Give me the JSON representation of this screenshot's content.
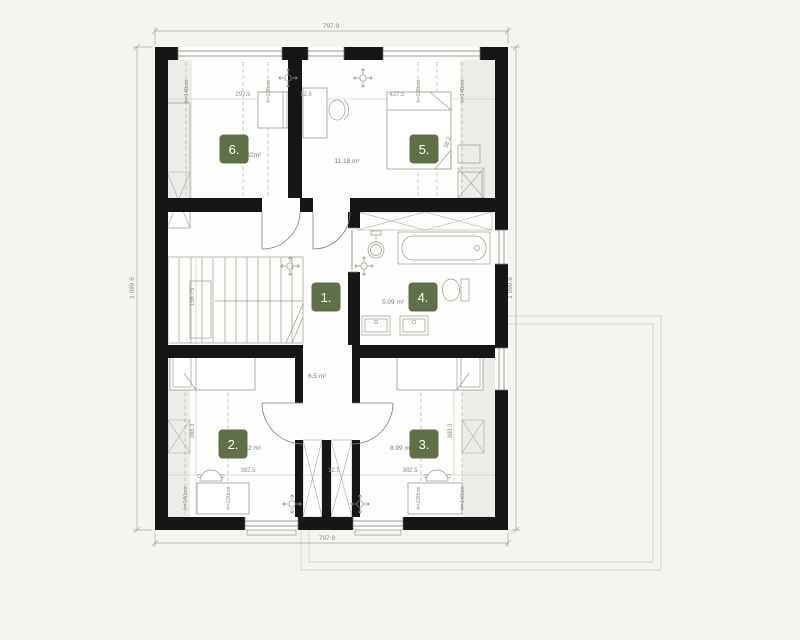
{
  "floorplan": {
    "overall": {
      "width_top": "797.9",
      "width_bottom": "797.9",
      "height_left": "1 099.6",
      "height_right": "1 099.6"
    },
    "rooms": [
      {
        "id": 1,
        "label": "1.",
        "area": "6.5 m²"
      },
      {
        "id": 2,
        "label": "2.",
        "area": "9.02 m²"
      },
      {
        "id": 3,
        "label": "3.",
        "area": "8.99 m²"
      },
      {
        "id": 4,
        "label": "4.",
        "area": "5.09 m²"
      },
      {
        "id": 5,
        "label": "5.",
        "area": "11.18 m²"
      },
      {
        "id": 6,
        "label": "6.",
        "area": "9.62m²"
      }
    ],
    "dims": {
      "room6_width": "297.5",
      "partition": "12.5",
      "room5_width": "427.5",
      "room2_width": "382.5",
      "partition_bottom": "12.5",
      "room3_width": "382.5",
      "room2_depth": "388.3",
      "room3_depth": "388.3",
      "stair_depth": "156.75",
      "bed_diag": "38.2"
    },
    "heights": {
      "low": "h=140cm",
      "high": "h=220cm"
    },
    "colors": {
      "badge_green": "#5d7047",
      "wall_black": "#161616",
      "background": "#f4f4f1"
    }
  }
}
